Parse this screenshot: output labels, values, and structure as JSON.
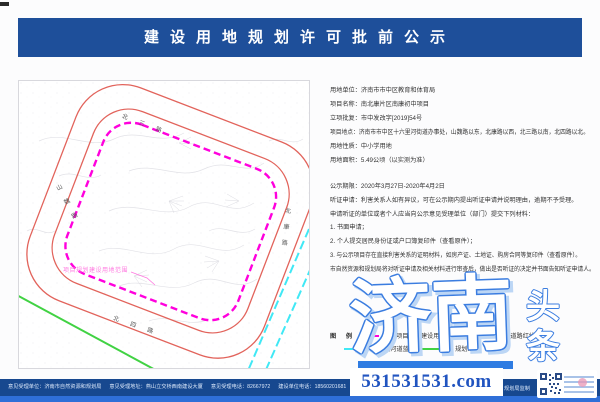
{
  "header": {
    "title": "建设用地规划许可批前公示"
  },
  "info": {
    "lines": [
      "用地单位：济南市市中区教育和体育局",
      "项目名称：南北康片区南康初中项目",
      "立项批复：市中发改字[2019]54号",
      "项目地点：济南市市中区十六里河街道办事处，山魏路以东，北康路以西，北三路以南，北四路以北。",
      "用地性质：中小学用地",
      "用地面积：5.49公顷（以实测为准）"
    ]
  },
  "notice": {
    "lines": [
      "公示期限：2020年3月27日-2020年4月2日",
      "听证申请：利害关系人如有异议，可在公示期内提出听证申请并说明理由，逾期不予受理。",
      "申请听证的单位或者个人应当向公示意见受理单位（部门）提交下列材料：",
      "1. 书面申请；",
      "2. 个人提交居民身份证或户口簿复印件（查看原件）；",
      "3. 与公示项目存在直接利害关系的证明材料，如房产证、土地证、购房合同等复印件（查看原件）。",
      "市自然资源和规划局将对听证申请及相关材料进行审查后，做出是否听证的决定并书面告知听证申请人。"
    ]
  },
  "legend": {
    "title": "图 例",
    "items": [
      {
        "label": "项目规划建设用地范围",
        "color": "#ff00dd",
        "style": "dashed"
      },
      {
        "label": "规划道路红线",
        "color": "#e8524a",
        "style": "solid"
      },
      {
        "label": "规划河道蓝线",
        "color": "#40e8f5",
        "style": "solid"
      },
      {
        "label": "规划绿线",
        "color": "#41d243",
        "style": "solid"
      }
    ]
  },
  "map": {
    "road_labels": [
      "北三路",
      "山魏路",
      "北康路",
      "北四路"
    ],
    "boundary_label": "项目规划建设用地范围",
    "boundary_color": "#ff00dd",
    "road_color": "#e2635b",
    "river_color": "#40e8f5",
    "green_color": "#41d243"
  },
  "footer": {
    "items": [
      {
        "label": "意见受理单位：",
        "value": "济南市自然资源和规划局"
      },
      {
        "label": "意见受理地址：",
        "value": "燕山立交桥西南建设大厦"
      },
      {
        "label": "意见受理电话：",
        "value": "82667972"
      },
      {
        "label": "建设单位电话：",
        "value": "18560201681"
      }
    ],
    "producer": "规划局监制"
  },
  "watermark": {
    "main": "济南",
    "side_top": "头",
    "side_bottom": "条",
    "url": "531531531.com"
  },
  "colors": {
    "header_bg": "#1e4f9a",
    "footer_bg": "#17488f",
    "footer_strip": "#2f6fd8",
    "watermark_blue": "#3b7de0"
  }
}
